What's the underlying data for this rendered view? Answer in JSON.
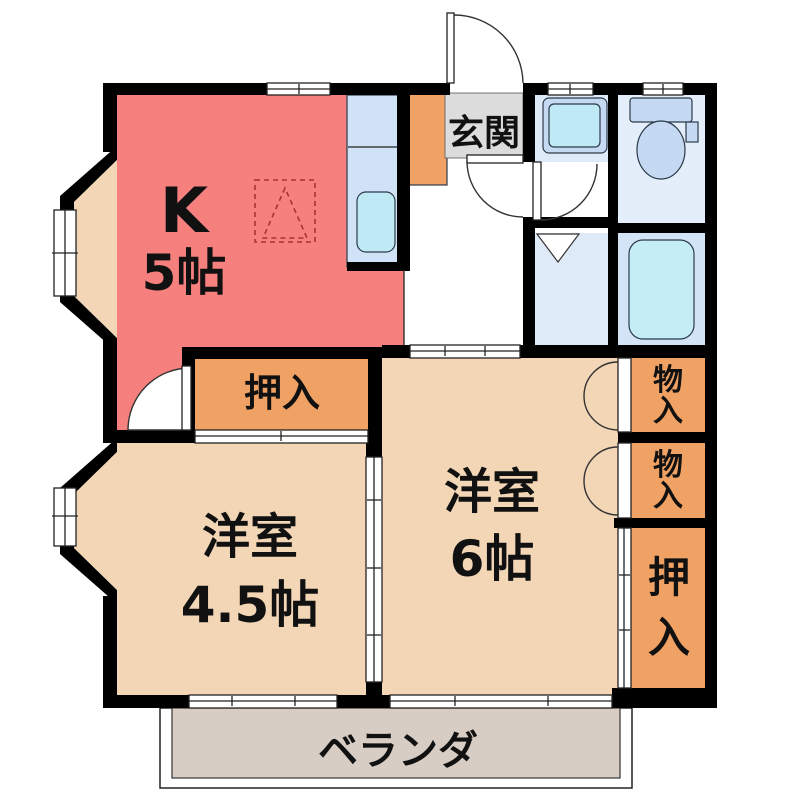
{
  "plan": {
    "kitchen": {
      "label": "K",
      "size": "5帖"
    },
    "entrance": {
      "label": "玄関"
    },
    "closet_top": {
      "label": "押入"
    },
    "room_45": {
      "label": "洋室",
      "size": "4.5帖"
    },
    "room_6": {
      "label": "洋室",
      "size": "6帖"
    },
    "storage_upper": {
      "label": "物入"
    },
    "storage_lower": {
      "label": "物入"
    },
    "closet_right": {
      "label": "押入"
    },
    "veranda": {
      "label": "ベランダ"
    }
  },
  "colors": {
    "wall": "#000000",
    "kitchen": "#F5807E",
    "room_beige": "#F3D6B6",
    "closet_orange": "#F0A264",
    "entrance_gray": "#DCDCDC",
    "veranda_gray": "#D8CDC5",
    "washroom_blue": "#DEEAF8",
    "toilet_blue": "#E4EEFA",
    "bath_blue": "#D2E4F5",
    "fixture_blue": "#C5D9F2",
    "tub_cyan": "#C4EDF6",
    "counter_blue": "#CFE2F6",
    "sink_cyan": "#BFEAF5"
  }
}
